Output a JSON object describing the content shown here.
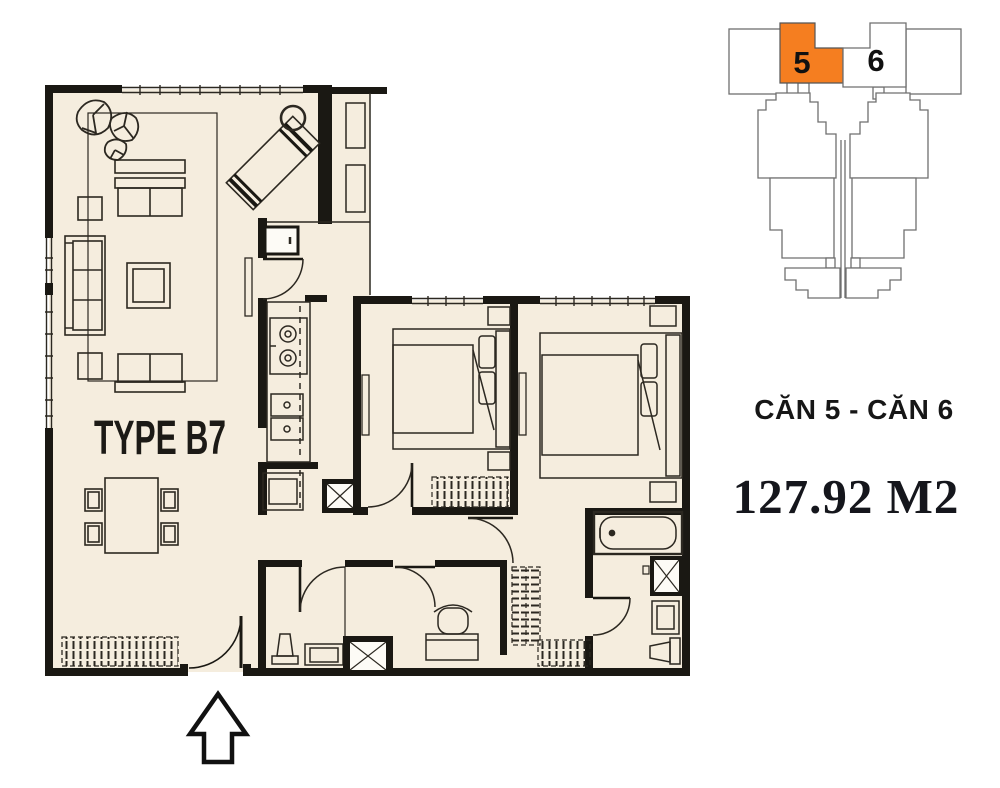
{
  "plan": {
    "type_label": "TYPE B7",
    "floor_color": "#f5edde",
    "wall_color": "#1a1813",
    "line_color": "#2c2821"
  },
  "key_map": {
    "unit5_label": "5",
    "unit6_label": "6",
    "highlight_color": "#f57e20",
    "outline_color": "#6f6f6f"
  },
  "info": {
    "units_label": "CĂN 5 - CĂN 6",
    "area_label": "127.92 M2"
  },
  "entrance": {
    "arrow_direction": "up"
  }
}
